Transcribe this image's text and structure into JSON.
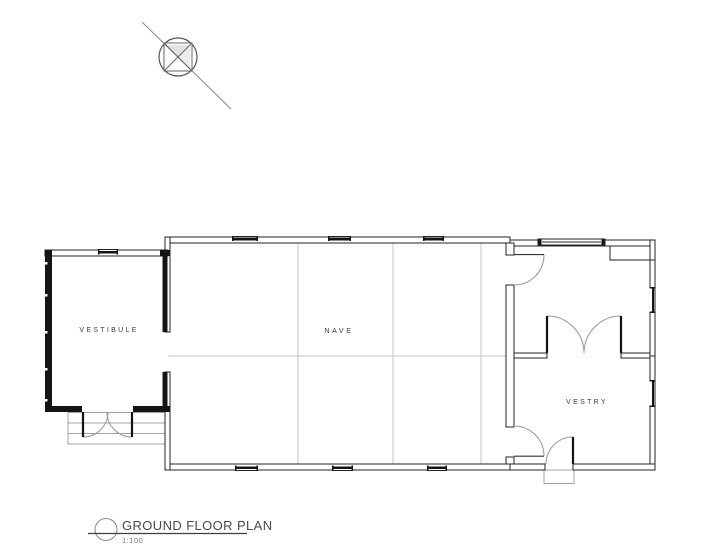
{
  "plan": {
    "rooms": [
      {
        "id": "vestibule",
        "label": "VESTIBULE"
      },
      {
        "id": "nave",
        "label": "NAVE"
      },
      {
        "id": "vestry",
        "label": "VESTRY"
      }
    ],
    "title_block": {
      "title": "GROUND FLOOR PLAN",
      "scale": "1:100"
    },
    "symbols": [
      "north-arrow-icon",
      "drawing-reference-bubble"
    ],
    "colors": {
      "wall_line": "#232323",
      "solid_wall": "#141414",
      "grid_line": "#c6c6c6",
      "door_swing": "#9c9c9c",
      "step_line": "#a3a3a3",
      "room_text": "#3b3b3b",
      "title_text": "#4a4a4a",
      "scale_text": "#777777",
      "background": "#ffffff"
    }
  }
}
